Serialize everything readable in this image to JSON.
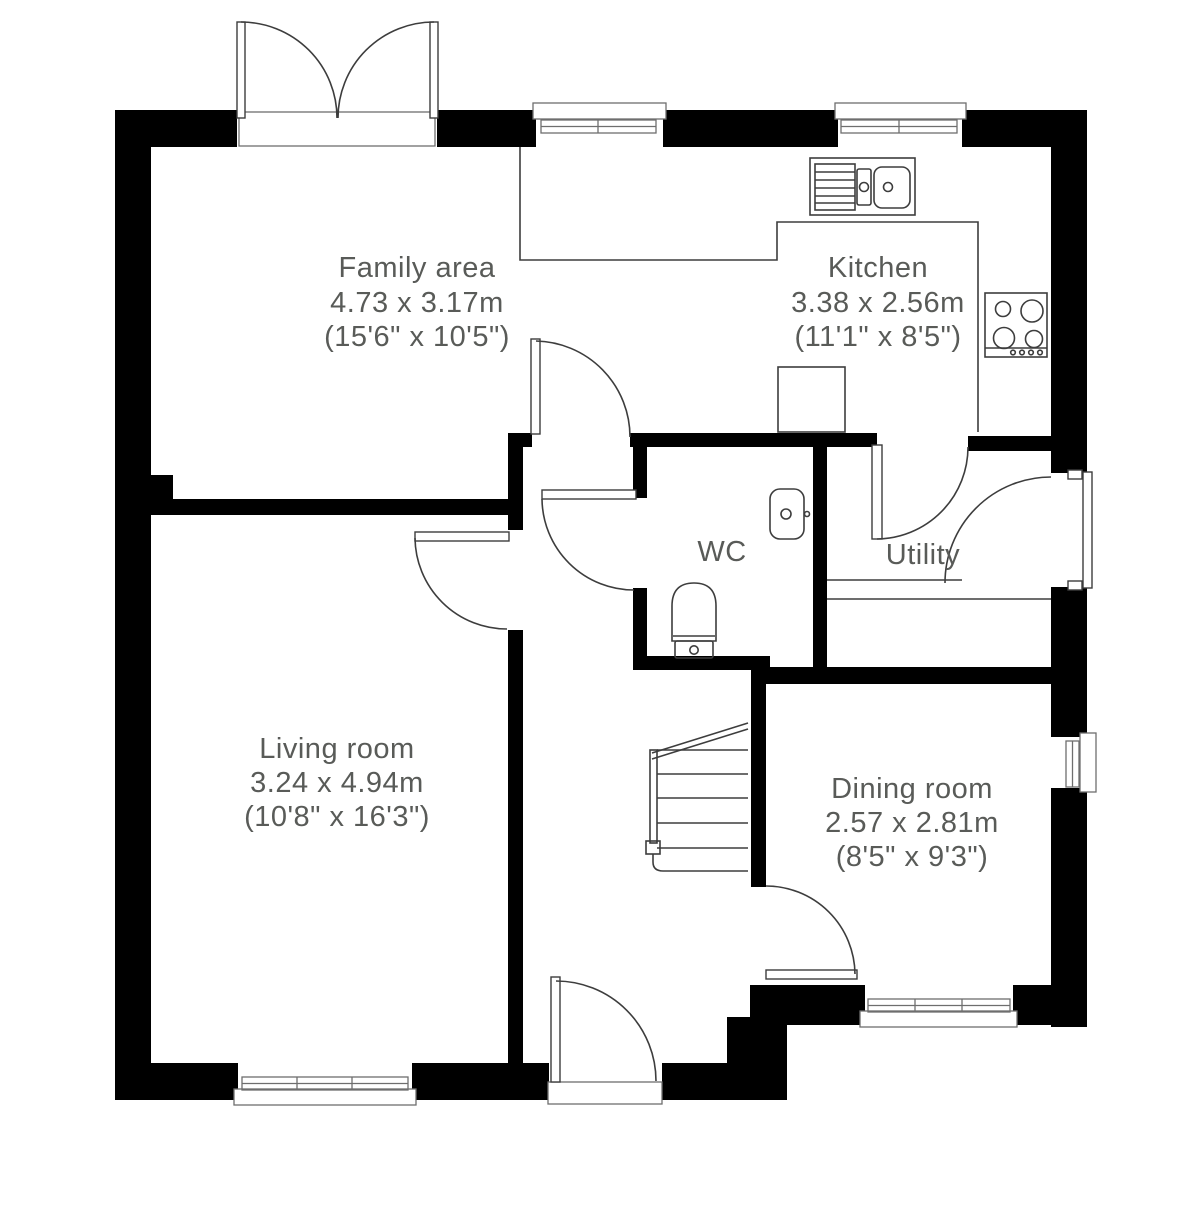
{
  "colors": {
    "wall": "#000000",
    "line": "#3d3d3d",
    "sill": "#6e6e6e",
    "label_text": "#595b58",
    "background": "#ffffff"
  },
  "rooms": [
    {
      "id": "family-area",
      "lines": [
        "Family area",
        "4.73 x 3.17m",
        "(15'6\" x 10'5\")"
      ]
    },
    {
      "id": "kitchen",
      "lines": [
        "Kitchen",
        "3.38 x 2.56m",
        "(11'1\" x 8'5\")"
      ]
    },
    {
      "id": "wc",
      "lines": [
        "WC"
      ]
    },
    {
      "id": "utility",
      "lines": [
        "Utility"
      ]
    },
    {
      "id": "living-room",
      "lines": [
        "Living room",
        "3.24 x 4.94m",
        "(10'8\" x 16'3\")"
      ]
    },
    {
      "id": "dining-room",
      "lines": [
        "Dining room",
        "2.57 x 2.81m",
        "(8'5\" x 9'3\")"
      ]
    }
  ],
  "fixtures": [
    "kitchen-sink-with-drainer",
    "four-ring-hob",
    "kitchen-worktop",
    "kitchen-appliance-unit",
    "wc-toilet",
    "wc-hand-basin",
    "utility-worktop",
    "staircase"
  ],
  "openings": [
    "french-doors-family-area",
    "window-kitchen-left",
    "window-kitchen-right",
    "window-living-room",
    "window-dining-room",
    "window-right-wall",
    "door-family-to-hall",
    "door-wc",
    "door-living-room",
    "door-dining-room",
    "door-utility-from-kitchen",
    "external-door-utility",
    "front-door"
  ]
}
